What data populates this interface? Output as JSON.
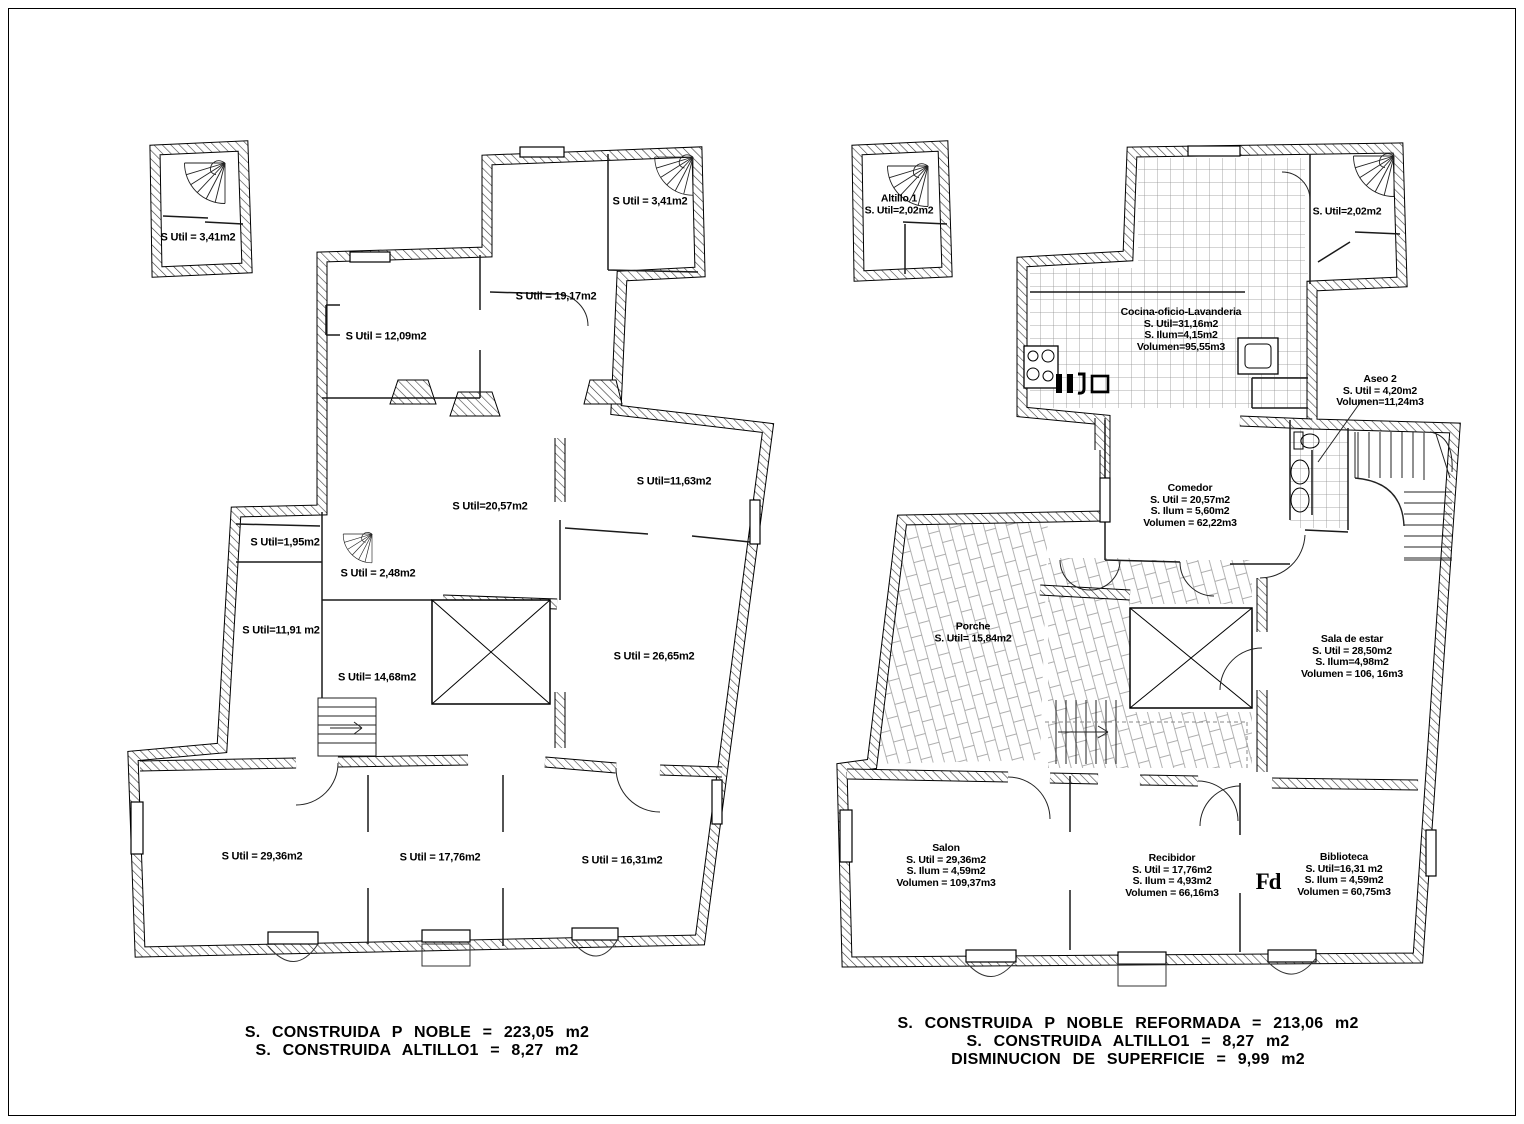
{
  "left": {
    "labels": [
      "S Util = 3,41m2",
      "S Util = 3,41m2",
      "S Util = 19,17m2",
      "S Util = 12,09m2",
      "S Util=20,57m2",
      "S Util=11,63m2",
      "S Util=1,95m2",
      "S Util = 2,48m2",
      "S Util=11,91 m2",
      "S Util= 14,68m2",
      "S Util = 26,65m2",
      "S Util = 29,36m2",
      "S Util = 17,76m2",
      "S Util = 16,31m2"
    ],
    "summary": [
      "S.  CONSTRUIDA  P  NOBLE  =  223,05  m2",
      "S.  CONSTRUIDA  ALTILLO1  =  8,27  m2"
    ]
  },
  "right": {
    "altillo": [
      "Altillo 1",
      "S. Util=2,02m2"
    ],
    "top_right_room": [
      "S. Util=2,02m2"
    ],
    "cocina": [
      "Cocina-oficio-Lavanderia",
      "S. Util=31,16m2",
      "S. Ilum=4,15m2",
      "Volumen=95,55m3"
    ],
    "aseo2": [
      "Aseo 2",
      "S. Util = 4,20m2",
      "Volumen=11,24m3"
    ],
    "comedor": [
      "Comedor",
      "S. Util = 20,57m2",
      "S. Ilum = 5,60m2",
      "Volumen = 62,22m3"
    ],
    "porche": [
      "Porche",
      "S. Util= 15,84m2"
    ],
    "sala_de_estar": [
      "Sala de estar",
      "S. Util = 28,50m2",
      "S. Ilum=4,98m2",
      "Volumen = 106, 16m3"
    ],
    "salon": [
      "Salon",
      "S. Util = 29,36m2",
      "S. Ilum = 4,59m2",
      "Volumen = 109,37m3"
    ],
    "recibidor": [
      "Recibidor",
      "S. Util = 17,76m2",
      "S. Ilum = 4,93m2",
      "Volumen = 66,16m3"
    ],
    "biblioteca": [
      "Biblioteca",
      "S. Util=16,31 m2",
      "S. Ilum = 4,59m2",
      "Volumen = 60,75m3"
    ],
    "stamp": "Fd",
    "summary": [
      "S.  CONSTRUIDA  P  NOBLE  REFORMADA  =  213,06  m2",
      "S.  CONSTRUIDA  ALTILLO1  =  8,27  m2",
      "DISMINUCION  DE  SUPERFICIE  =  9,99  m2"
    ]
  }
}
